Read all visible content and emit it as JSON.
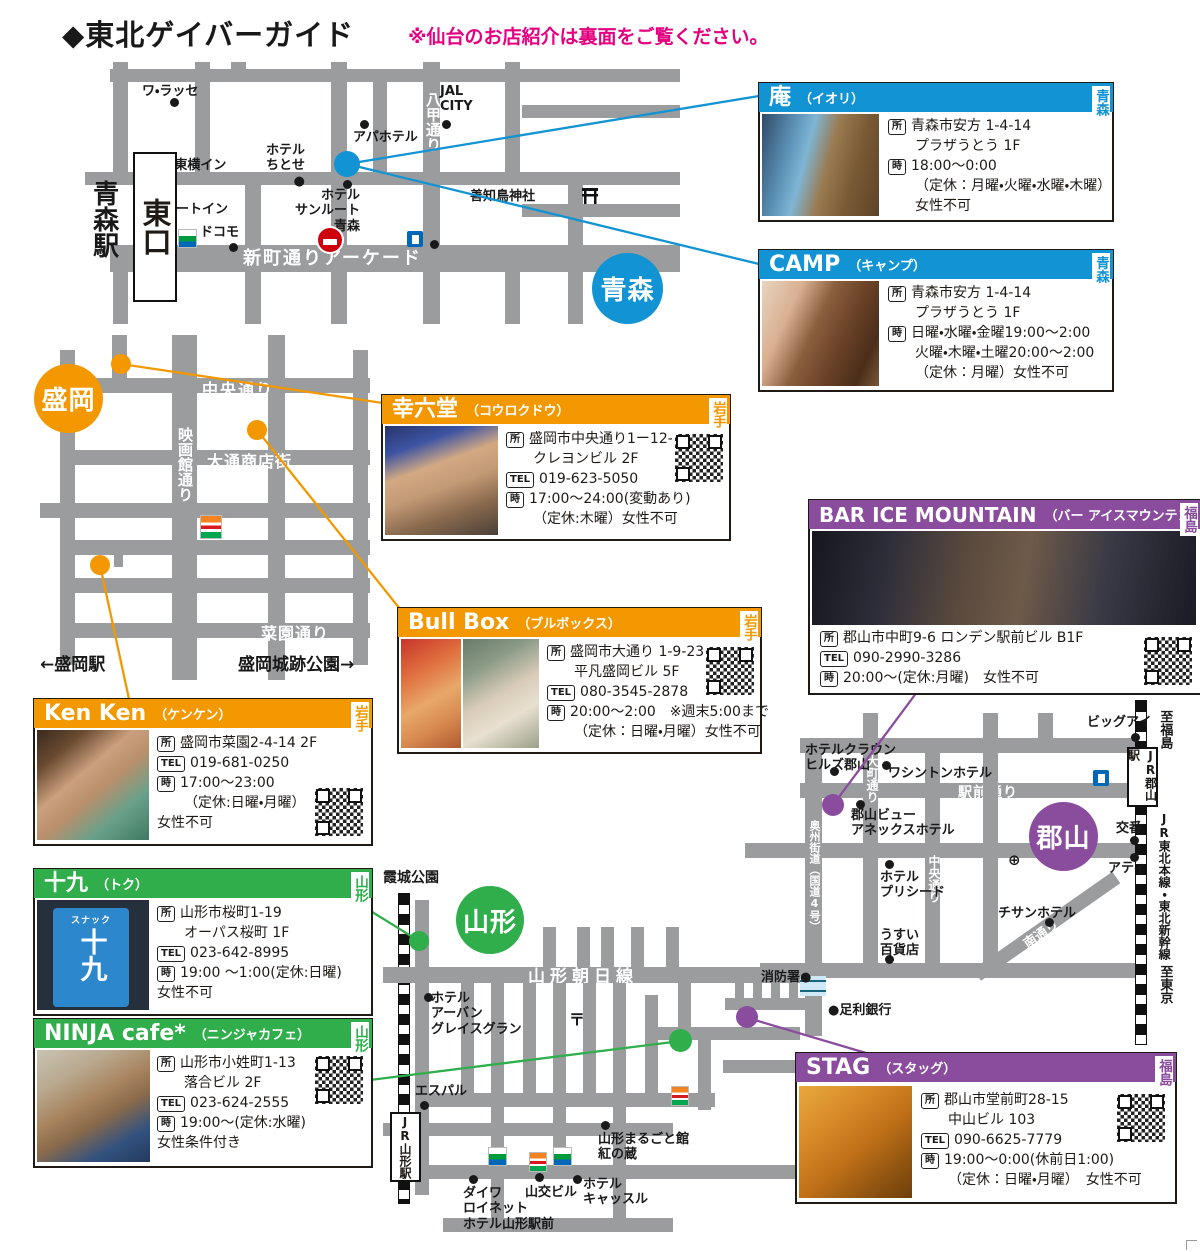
{
  "page": {
    "title": "◆東北ゲイバーガイド",
    "note": "※仙台のお店紹介は裏面をご覧ください。"
  },
  "legend": {
    "addr": "所",
    "time": "時",
    "tel": "TEL"
  },
  "colors": {
    "aomori_blue": "#1193d4",
    "iwate_orange": "#f39800",
    "yamagata_green": "#2fae4b",
    "fukushima_purple": "#8a4d9e",
    "road_gray": "#9b9c9e",
    "note_pink": "#e4007f"
  },
  "cards": [
    {
      "id": "iori",
      "name": "庵",
      "reading": "（イオリ）",
      "region": "青森",
      "addr1": "青森市安方 1-4-14",
      "addr2": "プラザうとう 1F",
      "time1": "18:00〜0:00",
      "time2": "（定休：月曜・火曜・水曜・木曜）",
      "time3": "女性不可"
    },
    {
      "id": "camp",
      "name": "CAMP",
      "reading": "（キャンプ）",
      "region": "青森",
      "addr1": "青森市安方 1-4-14",
      "addr2": "プラザうとう 1F",
      "time1": "日曜・水曜・金曜19:00〜2:00",
      "time2": "火曜・木曜・土曜20:00〜2:00",
      "time3": "（定休：月曜）女性不可"
    },
    {
      "id": "kourokudo",
      "name": "幸六堂",
      "reading": "（コウロクドウ）",
      "region": "岩手",
      "addr1": "盛岡市中央通り1ー12-3",
      "addr2": "クレヨンビル 2F",
      "tel": "019-623-5050",
      "time1": "17:00〜24:00(変動あり)",
      "time2": "（定休:木曜）女性不可"
    },
    {
      "id": "bullbox",
      "name": "Bull Box",
      "reading": "（ブルボックス）",
      "region": "岩手",
      "addr1": "盛岡市大通り 1-9-23",
      "addr2": "平凡盛岡ビル 5F",
      "tel": "080-3545-2878",
      "time1": "20:00〜2:00　※週末5:00まで",
      "time2": "（定休：日曜・月曜）女性不可"
    },
    {
      "id": "kenken",
      "name": "Ken Ken",
      "reading": "（ケンケン）",
      "region": "岩手",
      "addr1": "盛岡市菜園2-4-14 2F",
      "tel": "019-681-0250",
      "time1": "17:00〜23:00",
      "time2": "（定休:日曜・月曜）",
      "time3": "女性不可"
    },
    {
      "id": "toku",
      "name": "十九",
      "reading": "（トク）",
      "region": "山形",
      "addr1": "山形市桜町1-19",
      "addr2": "オーパス桜町 1F",
      "tel": "023-642-8995",
      "time1": "19:00 〜1:00(定休:日曜)",
      "time2": "女性不可",
      "sign_top": "スナック",
      "sign_main": "十九"
    },
    {
      "id": "ninja",
      "name": "NINJA cafe*",
      "reading": "（ニンジャカフェ）",
      "region": "山形",
      "addr1": "山形市小姓町1-13",
      "addr2": "落合ビル 2F",
      "tel": "023-624-2555",
      "time1": "19:00〜(定休:水曜)",
      "time2": "女性条件付き"
    },
    {
      "id": "icemountain",
      "name": "BAR ICE MOUNTAIN",
      "reading": "（バー アイスマウンテン）",
      "region": "福島",
      "addr1": "郡山市中町9-6 ロンデン駅前ビル B1F",
      "tel": "090-2990-3286",
      "time1": "20:00〜(定休:月曜)　女性不可"
    },
    {
      "id": "stag",
      "name": "STAG",
      "reading": "（スタッグ）",
      "region": "福島",
      "addr1": "郡山市堂前町28-15",
      "addr2": "中山ビル 103",
      "tel": "090-6625-7779",
      "time1": "19:00〜0:00(休前日1:00)",
      "time2": "（定休：日曜・月曜）　女性不可"
    }
  ],
  "maps": {
    "aomori": {
      "region_label": "青森",
      "station": "青森駅",
      "exit": "東口",
      "roads": {
        "hakko": "八甲通り",
        "shinmachi": "新町通りアーケード"
      },
      "pois": {
        "warasse": "ワ・ラッセ",
        "toyoko": "●東横イン",
        "route_inn": "ルートイン",
        "docomo": "ドコモ",
        "chitose": "ホテル\nちとせ●",
        "sunroute": "ホテル\nサンルート\n青森",
        "apa": "アパホテル",
        "jal": "JAL\nCITY",
        "utou": "善知鳥神社"
      }
    },
    "morioka": {
      "region_label": "盛岡",
      "roads": {
        "chuo": "中央通り",
        "eigakan": "映画館通り",
        "odori": "大通商店街",
        "saien": "菜園通り"
      },
      "notes": {
        "station": "←盛岡駅",
        "park": "盛岡城跡公園→"
      }
    },
    "yamagata": {
      "region_label": "山形",
      "park": "霞城公園",
      "station": "JR山形駅",
      "roads": {
        "asahi": "山形朝日線"
      },
      "pois": {
        "urban": "ホテル\nアーバン\nグレイスグラン",
        "post": "〒",
        "espal": "エスパル",
        "daiwa": "ダイワ\nロイネット\nホテル山形駅前",
        "yamako": "山交ビル",
        "castle": "ホテル\nキャッスル",
        "marugoto": "山形まるごと館\n紅の蔵"
      }
    },
    "koriyama": {
      "region_label": "郡山",
      "station": "JR郡山駅",
      "roads": {
        "ekimae": "駅前通り",
        "oshu": "奥州街道（国道4号）",
        "omachi": "大町通り",
        "chuo": "中央通り",
        "minami": "南通り"
      },
      "rail": {
        "to_fukushima": "至福島",
        "line": "JR東北本線・東北新幹線",
        "to_tokyo": "至東京"
      },
      "pois": {
        "bigi": "ビッグアイ",
        "crown": "ホテルクラウン\nヒルズ郡山",
        "washington": "ワシントンホテル",
        "view": "郡山ビュー\nアネックスホテル",
        "preseed": "ホテル\nプリシード",
        "usui": "うすい\n百貨店",
        "chisan": "チサンホテル",
        "koban": "交番",
        "ati": "アティ",
        "fire": "消防署●",
        "ashikaga": "●足利銀行",
        "hospital": "⊕"
      }
    }
  }
}
